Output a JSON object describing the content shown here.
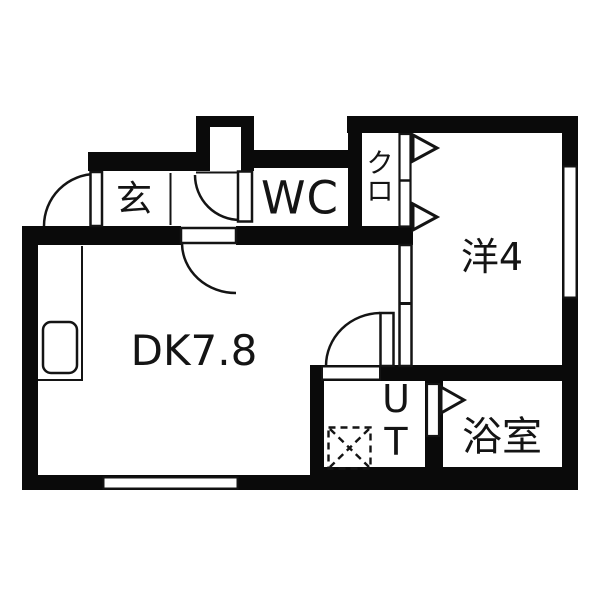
{
  "colors": {
    "background": "#ffffff",
    "wall": "#0a0a0a",
    "line": "#141414",
    "text": "#141414"
  },
  "rooms": {
    "genkan": {
      "label": "玄"
    },
    "wc": {
      "label": "WC"
    },
    "closet": {
      "label": "クロ"
    },
    "western_room": {
      "label": "洋4"
    },
    "dining_kitchen": {
      "label": "DK7.8"
    },
    "utility": {
      "label": "UT"
    },
    "bathroom": {
      "label": "浴室"
    }
  },
  "symbols": {
    "entrance_door": "swing-door-arc",
    "wc_door": "swing-door-arc",
    "dk_door": "swing-door-arc",
    "ut_door": "swing-door-arc",
    "closet_door": "folding-door-triangles",
    "bathroom_door": "folding-door-triangle",
    "dk_partition": "sliding-door",
    "washer_place": "dashed-box-cross",
    "kitchen_sink": "rounded-rect",
    "windows": [
      "south-window",
      "east-window"
    ]
  }
}
